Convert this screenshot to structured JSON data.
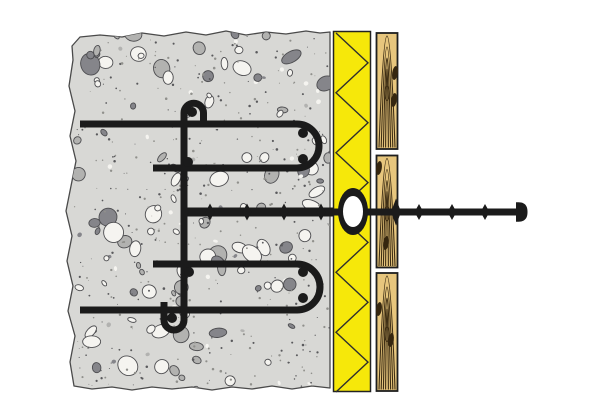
{
  "diagram": {
    "canvas": {
      "width": 600,
      "height": 400,
      "background": "#ffffff"
    },
    "colors": {
      "steel_black": "#1b1b1b",
      "concrete_gray": "#d8d8d5",
      "insulation_yellow": "#f6e80a",
      "wood_tan": "#e7c67d",
      "washer_hole_white": "#ffffff"
    },
    "concrete": {
      "fill": "#d8d8d5",
      "outline": "#4a4a4a",
      "outline_points": [
        [
          72,
          46
        ],
        [
          80,
          37
        ],
        [
          100,
          35
        ],
        [
          122,
          37
        ],
        [
          142,
          33
        ],
        [
          164,
          36
        ],
        [
          186,
          32
        ],
        [
          206,
          35
        ],
        [
          226,
          31
        ],
        [
          246,
          35
        ],
        [
          266,
          32
        ],
        [
          286,
          34
        ],
        [
          306,
          31
        ],
        [
          320,
          33
        ],
        [
          330,
          32
        ],
        [
          330,
          388
        ],
        [
          312,
          386
        ],
        [
          292,
          389
        ],
        [
          272,
          386
        ],
        [
          252,
          389
        ],
        [
          232,
          387
        ],
        [
          212,
          390
        ],
        [
          192,
          387
        ],
        [
          172,
          389
        ],
        [
          152,
          387
        ],
        [
          132,
          390
        ],
        [
          112,
          387
        ],
        [
          92,
          389
        ],
        [
          74,
          386
        ],
        [
          70,
          362
        ],
        [
          75,
          336
        ],
        [
          68,
          311
        ],
        [
          73,
          286
        ],
        [
          67,
          261
        ],
        [
          72,
          236
        ],
        [
          66,
          211
        ],
        [
          71,
          186
        ],
        [
          76,
          161
        ],
        [
          70,
          136
        ],
        [
          75,
          111
        ],
        [
          69,
          86
        ],
        [
          73,
          60
        ]
      ],
      "texture": {
        "seed": 11,
        "stones": 150,
        "specks": 420,
        "stone_light": "#f5f4f0",
        "stone_mid": "#b2b2b0",
        "stone_dark": "#85858a",
        "stone_outline": "#4d4d50",
        "speck_dark": "#59595c",
        "speck_light": "#90908c"
      }
    },
    "insulation": {
      "x": 333.5,
      "y": 31.5,
      "width": 37,
      "height": 360,
      "fill": "#f6e80a",
      "line": "#2e2e2e",
      "zigzag_segments": 12
    },
    "cladding": {
      "x": 376.5,
      "width": 21,
      "fill": "#e7c67d",
      "grain": "#3e2e14",
      "border": "#1f1f1f",
      "boards": [
        {
          "y": 33,
          "height": 116
        },
        {
          "y": 155.5,
          "height": 112
        },
        {
          "y": 273,
          "height": 118
        }
      ],
      "knots": [
        [
          395,
          73
        ],
        [
          394,
          100
        ],
        [
          379,
          168
        ],
        [
          386,
          243
        ],
        [
          379,
          309
        ],
        [
          391,
          340
        ]
      ]
    },
    "rebar": {
      "color": "#1b1b1b",
      "stroke_width": 7,
      "dot_radius": 5,
      "upper_path": "M80,124 H297 A22,22 0 0 1 297,168 H153",
      "lower_path": "M153,264 H297 A23,23 0 0 1 297,310 H80",
      "vertical_path": "M203.5,127 V113 A9.75,9.75 0 0 0 184,113 V320 A10,10 0 0 1 164,320 V302",
      "dots": [
        [
          192,
          112
        ],
        [
          303,
          133
        ],
        [
          303,
          159
        ],
        [
          188,
          162
        ],
        [
          189,
          272
        ],
        [
          303,
          272
        ],
        [
          303,
          298
        ],
        [
          172,
          318
        ]
      ]
    },
    "anchor": {
      "color": "#1b1b1b",
      "y": 212,
      "rod_inner": {
        "x1": 182,
        "x2": 333,
        "thickness": 9
      },
      "rod_outer": {
        "x1": 331,
        "x2": 518,
        "thickness": 7
      },
      "barbs_inner": {
        "x": [
          210,
          247,
          284,
          321
        ],
        "half_w": 4.5,
        "half_h": 8.5
      },
      "barbs_outer": {
        "x": [
          419,
          452,
          485
        ],
        "half_w": 4.5,
        "half_h": 8
      },
      "flange": {
        "x": 396,
        "half_w": 5,
        "half_h": 13.5
      },
      "washer": {
        "cx": 353,
        "cy": 211.5,
        "rx": 15,
        "ry": 23.5,
        "hole_rx": 10,
        "hole_ry": 15.5,
        "hole_fill": "#ffffff"
      },
      "head": {
        "x": 516,
        "cy": 212,
        "width": 9.5,
        "half_h": 9.7
      }
    }
  }
}
